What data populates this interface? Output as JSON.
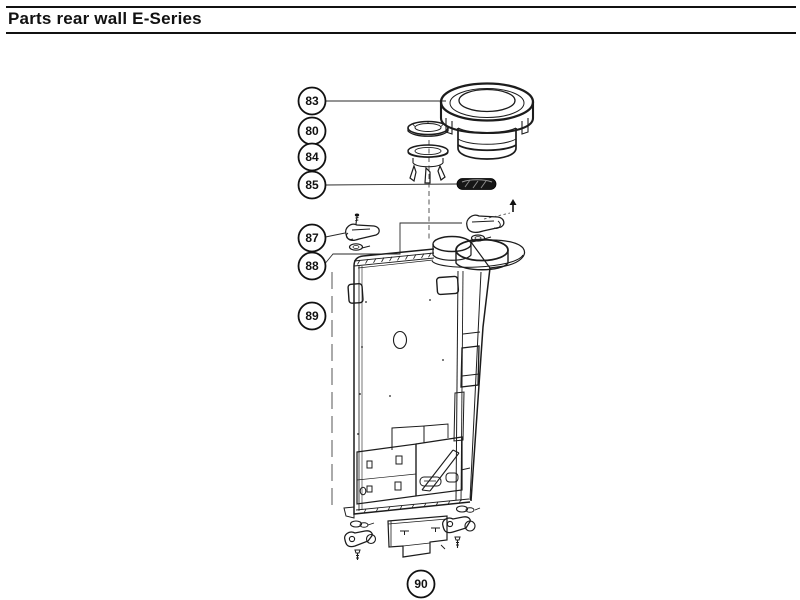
{
  "header": {
    "title": "Parts rear wall E-Series"
  },
  "callouts": [
    {
      "label": "83"
    },
    {
      "label": "80"
    },
    {
      "label": "84"
    },
    {
      "label": "85"
    },
    {
      "label": "87"
    },
    {
      "label": "88"
    },
    {
      "label": "89"
    },
    {
      "label": "90"
    }
  ]
}
